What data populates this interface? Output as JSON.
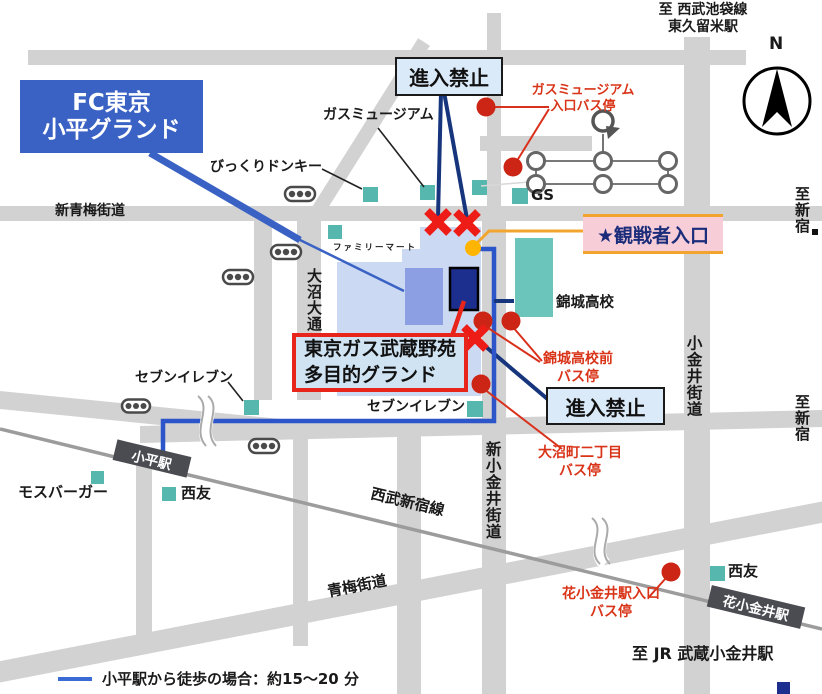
{
  "title_box": {
    "line1": "FC東京",
    "line2": "小平グランド"
  },
  "boxes": {
    "no_entry_top": "進入禁止",
    "no_entry_bottom": "進入禁止",
    "spectator_entrance": "★観戦者入口",
    "ground_label": {
      "line1": "東京ガス武蔵野苑",
      "line2": "多目的グランド"
    }
  },
  "stations": {
    "kodaira": "小平駅",
    "hanakoganei": "花小金井駅"
  },
  "roads": {
    "shin_oume_kaido": "新青梅街道",
    "oume_kaido": "青梅街道",
    "seibu_shinjuku_line": "西武新宿線",
    "shin_koganei_kaido": "新小金井街道",
    "koganei_kaido": "小金井街道",
    "onuma_odori": "大沼大通り"
  },
  "directions": {
    "to_seibu_ikebukuro_line1": "至 西武池袋線",
    "to_seibu_ikebukuro_line2": "東久留米駅",
    "to_shinjuku_upper": "至新宿",
    "to_shinjuku_lower": "至新宿",
    "to_jr_musashikoganei": "至 JR 武蔵小金井駅"
  },
  "pois": {
    "gas_museum": "ガスミュージアム",
    "bikkuri_donkey": "びっくりドンキー",
    "family_mart": "ファミリーマート",
    "gas_station": "GS",
    "kinjo_high_school": "錦城高校",
    "seven_eleven_west": "セブンイレブン",
    "seven_eleven_center": "セブンイレブン",
    "mos_burger": "モスバーガー",
    "seiyu_west": "西友",
    "seiyu_east": "西友"
  },
  "bus_stops": {
    "gas_museum_entrance": {
      "line1": "ガスミュージアム",
      "line2": "入口バス停"
    },
    "kinjo_mae": {
      "line1": "錦城高校前",
      "line2": "バス停"
    },
    "onuma_2chome": {
      "line1": "大沼町二丁目",
      "line2": "バス停"
    },
    "hanakoganei_iriguchi": {
      "line1": "花小金井駅入口",
      "line2": "バス停"
    }
  },
  "compass": {
    "north": "N"
  },
  "legend": {
    "walk_note": "小平駅から徒歩の場合：約15～20 分"
  },
  "colors": {
    "road_gray": "#d2d2d2",
    "railway_gray": "#9c9c9c",
    "brand_blue": "#3a62c4",
    "route_blue": "#2b55c8",
    "navy_pointer": "#16357d",
    "ground_lavender": "#ccd9f3",
    "field_periwinkle": "#8c9fe3",
    "building_navy": "#1c2f8f",
    "school_teal": "#6cc5bb",
    "poi_teal": "#56b7ae",
    "alert_red": "#ed1c16",
    "bus_red": "#cc2415",
    "entrance_yellow": "#ffb400",
    "entrance_orange": "#f2a52e",
    "entrance_pink": "#f7cdd8",
    "label_blue_fill": "#dbeaf8",
    "ground_box_fill": "#cfe3f2"
  }
}
